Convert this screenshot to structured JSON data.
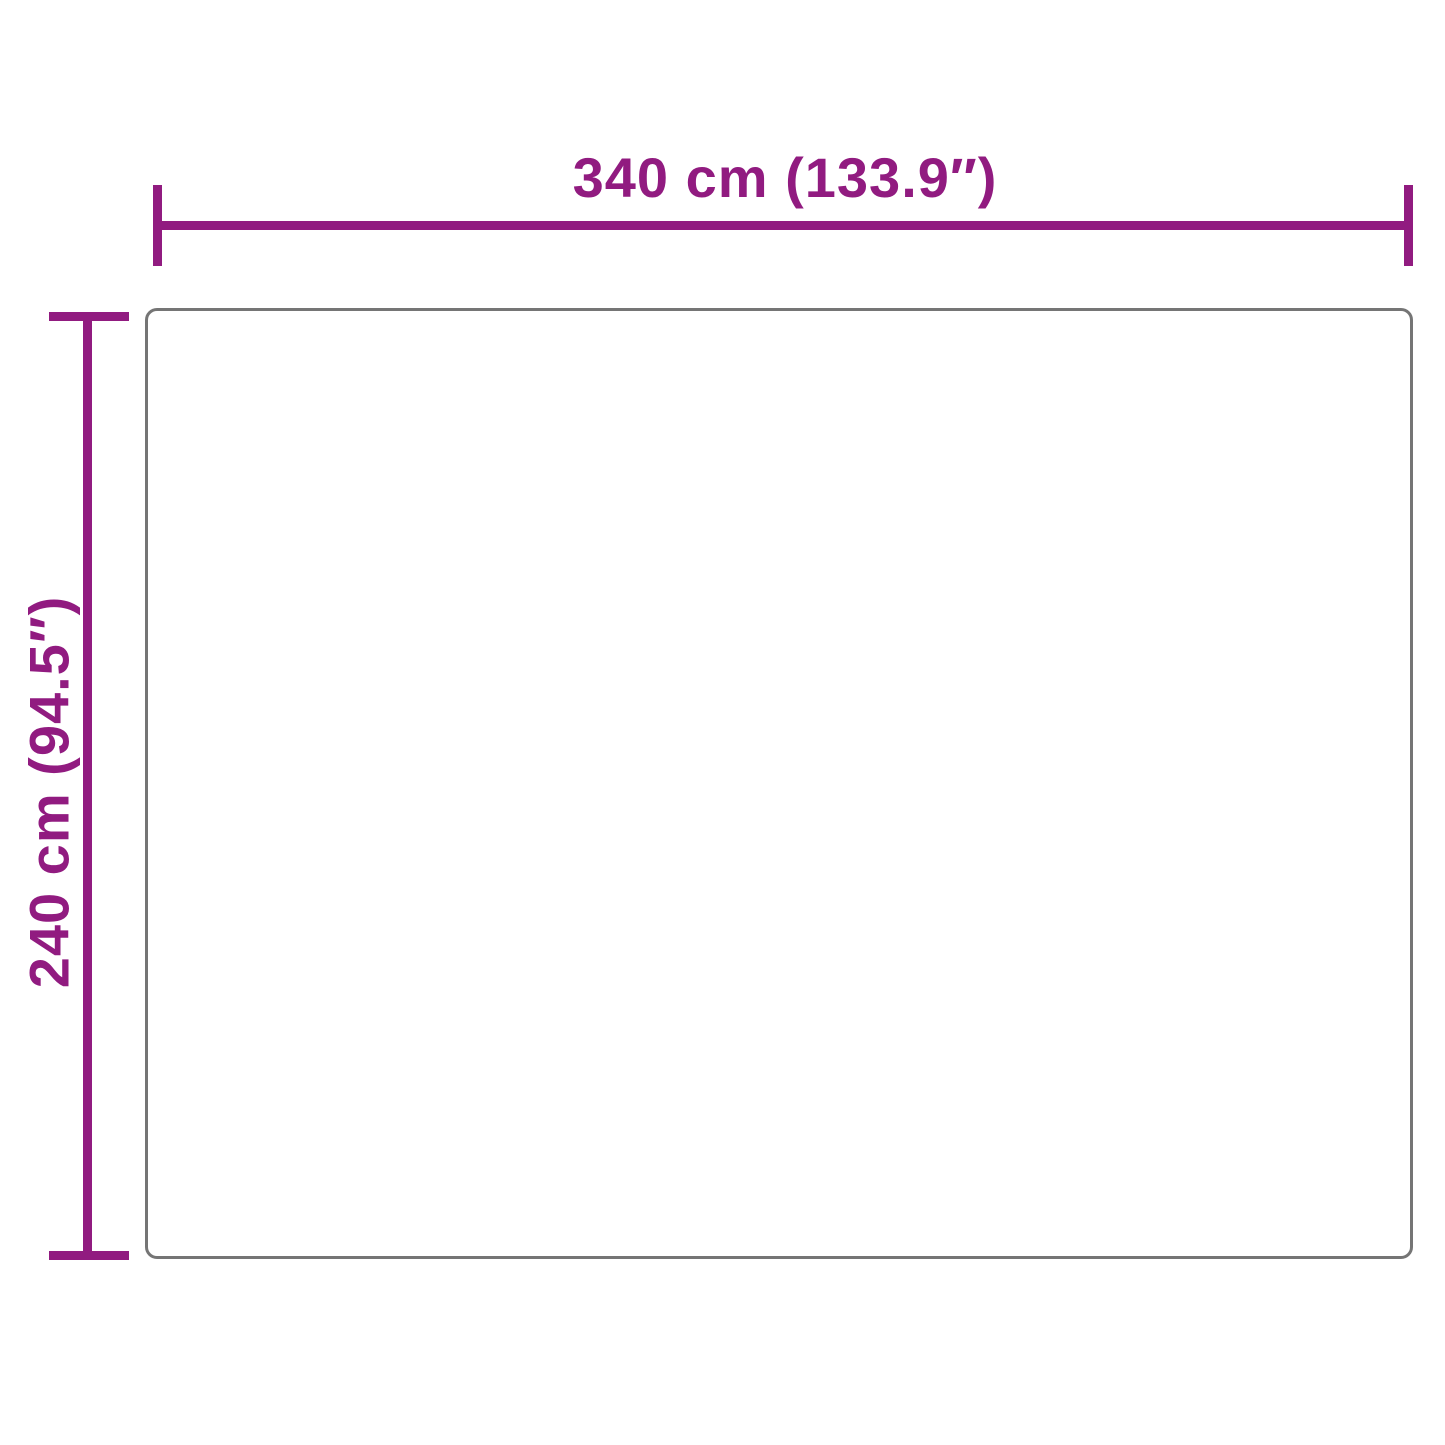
{
  "diagram": {
    "type": "product-dimension-diagram",
    "width_label": "340 cm (133.9″)",
    "height_label": "240 cm (94.5″)",
    "colors": {
      "accent": "#911b80",
      "outline": "#757575",
      "background": "#ffffff"
    }
  }
}
